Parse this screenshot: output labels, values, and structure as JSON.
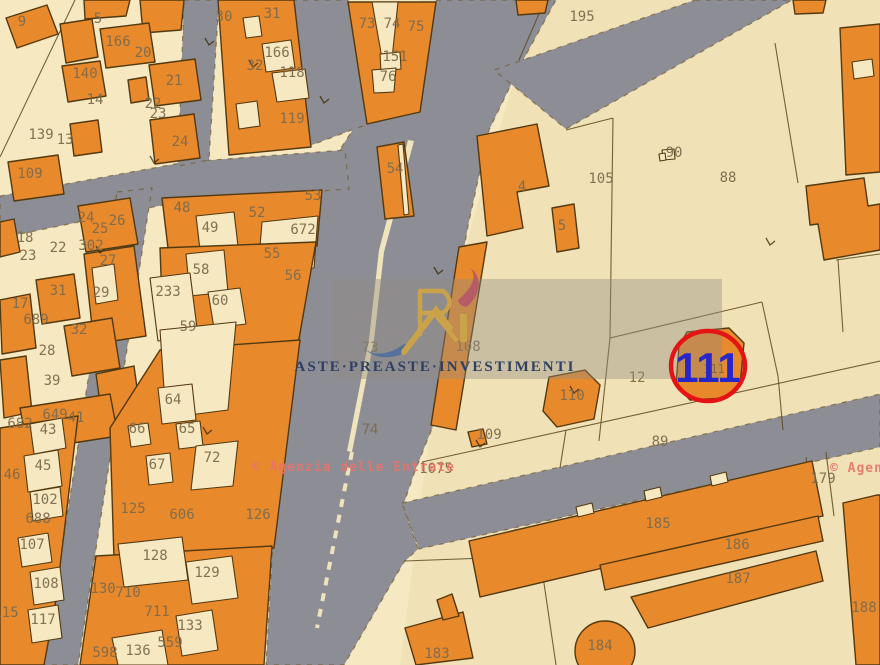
{
  "map": {
    "colors": {
      "parcel_fill": "#f6e8c1",
      "parcel_shade": "#f1e1b6",
      "building": "#e8892c",
      "building_edge": "#53390f",
      "road": "#8d8d95",
      "boundary": "#6b5524",
      "label": "#7d6b4d",
      "brand_navy": "#2e3f63",
      "brand_gold": "#c9a24a",
      "brand_red": "#b4566a",
      "brand_blue": "#4f6fa0",
      "panel": "rgba(145,140,130,0.40)",
      "agency_red": "#e8736a",
      "highlight_red": "#e51414",
      "highlight_blue": "#2626cb"
    },
    "highlight": {
      "parcel": "111",
      "x": 708,
      "y": 382,
      "circle": {
        "cx": 708,
        "cy": 366,
        "rx": 37,
        "ry": 35
      },
      "under": {
        "t": "111",
        "x": 714,
        "y": 373
      }
    },
    "watermarks": {
      "brand": {
        "text": "ASTE·PREASTE·INVESTIMENTI"
      },
      "agency": {
        "text": "© Agenzia delle Entrate",
        "instances": [
          {
            "x": 252,
            "y": 471
          },
          {
            "x": 830,
            "y": 472
          }
        ]
      }
    },
    "labels": [
      {
        "t": "9",
        "x": 22,
        "y": 26
      },
      {
        "t": "5",
        "x": 98,
        "y": 23
      },
      {
        "t": "166",
        "x": 118,
        "y": 46
      },
      {
        "t": "20",
        "x": 143,
        "y": 57
      },
      {
        "t": "140",
        "x": 85,
        "y": 78
      },
      {
        "t": "21",
        "x": 174,
        "y": 85
      },
      {
        "t": "14",
        "x": 95,
        "y": 104
      },
      {
        "t": "22",
        "x": 153,
        "y": 108
      },
      {
        "t": "23",
        "x": 158,
        "y": 118
      },
      {
        "t": "139",
        "x": 41,
        "y": 139
      },
      {
        "t": "13",
        "x": 65,
        "y": 144
      },
      {
        "t": "24",
        "x": 180,
        "y": 146
      },
      {
        "t": "109",
        "x": 30,
        "y": 178
      },
      {
        "t": "30",
        "x": 224,
        "y": 21
      },
      {
        "t": "31",
        "x": 272,
        "y": 18
      },
      {
        "t": "166",
        "x": 277,
        "y": 57
      },
      {
        "t": "32",
        "x": 255,
        "y": 70
      },
      {
        "t": "118",
        "x": 292,
        "y": 77
      },
      {
        "t": "119",
        "x": 292,
        "y": 123
      },
      {
        "t": "73",
        "x": 367,
        "y": 28
      },
      {
        "t": "74",
        "x": 392,
        "y": 28
      },
      {
        "t": "75",
        "x": 416,
        "y": 31
      },
      {
        "t": "151",
        "x": 395,
        "y": 61
      },
      {
        "t": "76",
        "x": 388,
        "y": 81
      },
      {
        "t": "54",
        "x": 395,
        "y": 173
      },
      {
        "t": "73",
        "x": 370,
        "y": 352
      },
      {
        "t": "74",
        "x": 370,
        "y": 434
      },
      {
        "t": "24",
        "x": 86,
        "y": 222
      },
      {
        "t": "26",
        "x": 117,
        "y": 225
      },
      {
        "t": "25",
        "x": 100,
        "y": 233
      },
      {
        "t": "18",
        "x": 25,
        "y": 242
      },
      {
        "t": "302",
        "x": 91,
        "y": 250
      },
      {
        "t": "22",
        "x": 58,
        "y": 252
      },
      {
        "t": "23",
        "x": 28,
        "y": 260
      },
      {
        "t": "27",
        "x": 108,
        "y": 265
      },
      {
        "t": "31",
        "x": 58,
        "y": 295
      },
      {
        "t": "29",
        "x": 101,
        "y": 297
      },
      {
        "t": "17",
        "x": 20,
        "y": 308
      },
      {
        "t": "689",
        "x": 36,
        "y": 324
      },
      {
        "t": "32",
        "x": 79,
        "y": 334
      },
      {
        "t": "28",
        "x": 47,
        "y": 355
      },
      {
        "t": "39",
        "x": 52,
        "y": 385
      },
      {
        "t": "649",
        "x": 55,
        "y": 419
      },
      {
        "t": "41",
        "x": 76,
        "y": 422
      },
      {
        "t": "48",
        "x": 182,
        "y": 212
      },
      {
        "t": "49",
        "x": 210,
        "y": 232
      },
      {
        "t": "52",
        "x": 257,
        "y": 217
      },
      {
        "t": "53",
        "x": 313,
        "y": 200
      },
      {
        "t": "672",
        "x": 303,
        "y": 234
      },
      {
        "t": "55",
        "x": 272,
        "y": 258
      },
      {
        "t": "56",
        "x": 293,
        "y": 280
      },
      {
        "t": "58",
        "x": 201,
        "y": 274
      },
      {
        "t": "233",
        "x": 168,
        "y": 296
      },
      {
        "t": "60",
        "x": 220,
        "y": 305
      },
      {
        "t": "59",
        "x": 188,
        "y": 331
      },
      {
        "t": "64",
        "x": 173,
        "y": 404
      },
      {
        "t": "66",
        "x": 137,
        "y": 433
      },
      {
        "t": "65",
        "x": 187,
        "y": 433
      },
      {
        "t": "72",
        "x": 212,
        "y": 462
      },
      {
        "t": "67",
        "x": 157,
        "y": 469
      },
      {
        "t": "125",
        "x": 133,
        "y": 513
      },
      {
        "t": "606",
        "x": 182,
        "y": 519
      },
      {
        "t": "126",
        "x": 258,
        "y": 519
      },
      {
        "t": "128",
        "x": 155,
        "y": 560
      },
      {
        "t": "129",
        "x": 207,
        "y": 577
      },
      {
        "t": "130",
        "x": 103,
        "y": 593
      },
      {
        "t": "710",
        "x": 128,
        "y": 597
      },
      {
        "t": "711",
        "x": 157,
        "y": 616
      },
      {
        "t": "133",
        "x": 190,
        "y": 630
      },
      {
        "t": "559",
        "x": 170,
        "y": 647
      },
      {
        "t": "136",
        "x": 138,
        "y": 655
      },
      {
        "t": "598",
        "x": 105,
        "y": 657
      },
      {
        "t": "682",
        "x": 20,
        "y": 428
      },
      {
        "t": "43",
        "x": 48,
        "y": 434
      },
      {
        "t": "45",
        "x": 43,
        "y": 470
      },
      {
        "t": "46",
        "x": 12,
        "y": 479
      },
      {
        "t": "102",
        "x": 45,
        "y": 504
      },
      {
        "t": "688",
        "x": 38,
        "y": 523
      },
      {
        "t": "107",
        "x": 32,
        "y": 549
      },
      {
        "t": "108",
        "x": 46,
        "y": 588
      },
      {
        "t": "115",
        "x": 6,
        "y": 617
      },
      {
        "t": "117",
        "x": 43,
        "y": 624
      },
      {
        "t": "195",
        "x": 582,
        "y": 21
      },
      {
        "t": "4",
        "x": 522,
        "y": 191
      },
      {
        "t": "5",
        "x": 562,
        "y": 230
      },
      {
        "t": "105",
        "x": 601,
        "y": 183
      },
      {
        "t": "90",
        "x": 674,
        "y": 157
      },
      {
        "t": "88",
        "x": 728,
        "y": 182
      },
      {
        "t": "108",
        "x": 468,
        "y": 351
      },
      {
        "t": "110",
        "x": 572,
        "y": 400
      },
      {
        "t": "12",
        "x": 637,
        "y": 382
      },
      {
        "t": "109",
        "x": 489,
        "y": 439
      },
      {
        "t": "89",
        "x": 660,
        "y": 446
      },
      {
        "t": "1075",
        "x": 436,
        "y": 473
      },
      {
        "t": "179",
        "x": 823,
        "y": 483
      },
      {
        "t": "185",
        "x": 658,
        "y": 528
      },
      {
        "t": "186",
        "x": 737,
        "y": 549
      },
      {
        "t": "187",
        "x": 738,
        "y": 583
      },
      {
        "t": "188",
        "x": 864,
        "y": 612
      },
      {
        "t": "184",
        "x": 600,
        "y": 650
      },
      {
        "t": "183",
        "x": 437,
        "y": 658
      }
    ]
  }
}
